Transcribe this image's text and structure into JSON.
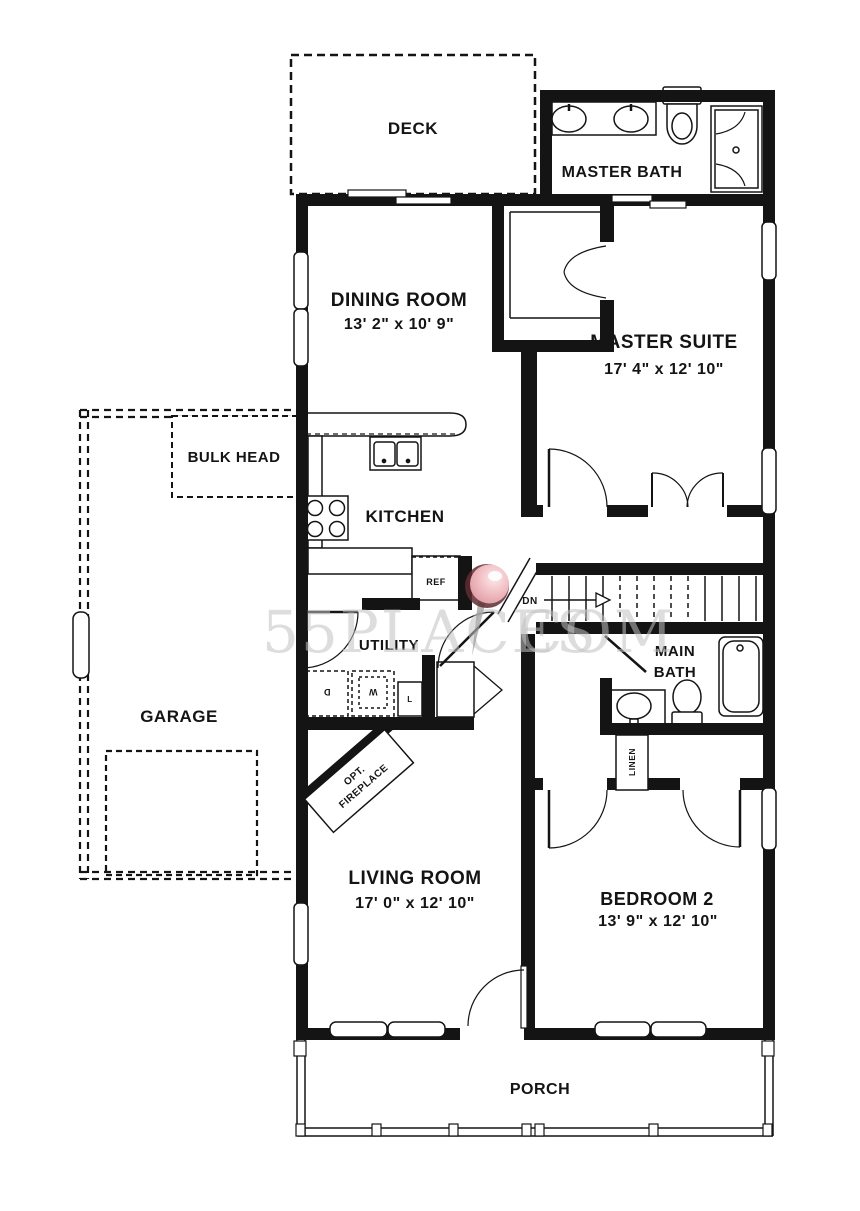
{
  "rooms": {
    "deck": {
      "label": "DECK"
    },
    "master_bath": {
      "label": "MASTER BATH"
    },
    "dining_room": {
      "label": "DINING ROOM",
      "dimensions": "13' 2\" x 10' 9\""
    },
    "master_suite": {
      "label": "MASTER SUITE",
      "dimensions": "17' 4\" x 12' 10\""
    },
    "bulk_head": {
      "label": "BULK HEAD"
    },
    "kitchen": {
      "label": "KITCHEN"
    },
    "garage": {
      "label": "GARAGE"
    },
    "utility": {
      "label": "UTILITY"
    },
    "main_bath": {
      "label_line1": "MAIN",
      "label_line2": "BATH"
    },
    "living_room": {
      "label": "LIVING ROOM",
      "dimensions": "17' 0\" x 12' 10\""
    },
    "bedroom_2": {
      "label": "BEDROOM 2",
      "dimensions": "13' 9\" x 12' 10\""
    },
    "porch": {
      "label": "PORCH"
    }
  },
  "annotations": {
    "fireplace_line1": "OPT.",
    "fireplace_line2": "FIREPLACE",
    "linen": "LINEN",
    "stairs_direction": "DN",
    "refrigerator": "REF",
    "dryer": "D",
    "washer": "W",
    "laundry_tub": "L"
  },
  "watermark": {
    "text_left": "55PLACES",
    "text_right": "COM",
    "pin_color": "#eebac0",
    "pin_shadow_color": "#5f2b31",
    "text_color": "#c2c2c2"
  },
  "colors": {
    "wall": "#141414",
    "background": "#ffffff"
  }
}
